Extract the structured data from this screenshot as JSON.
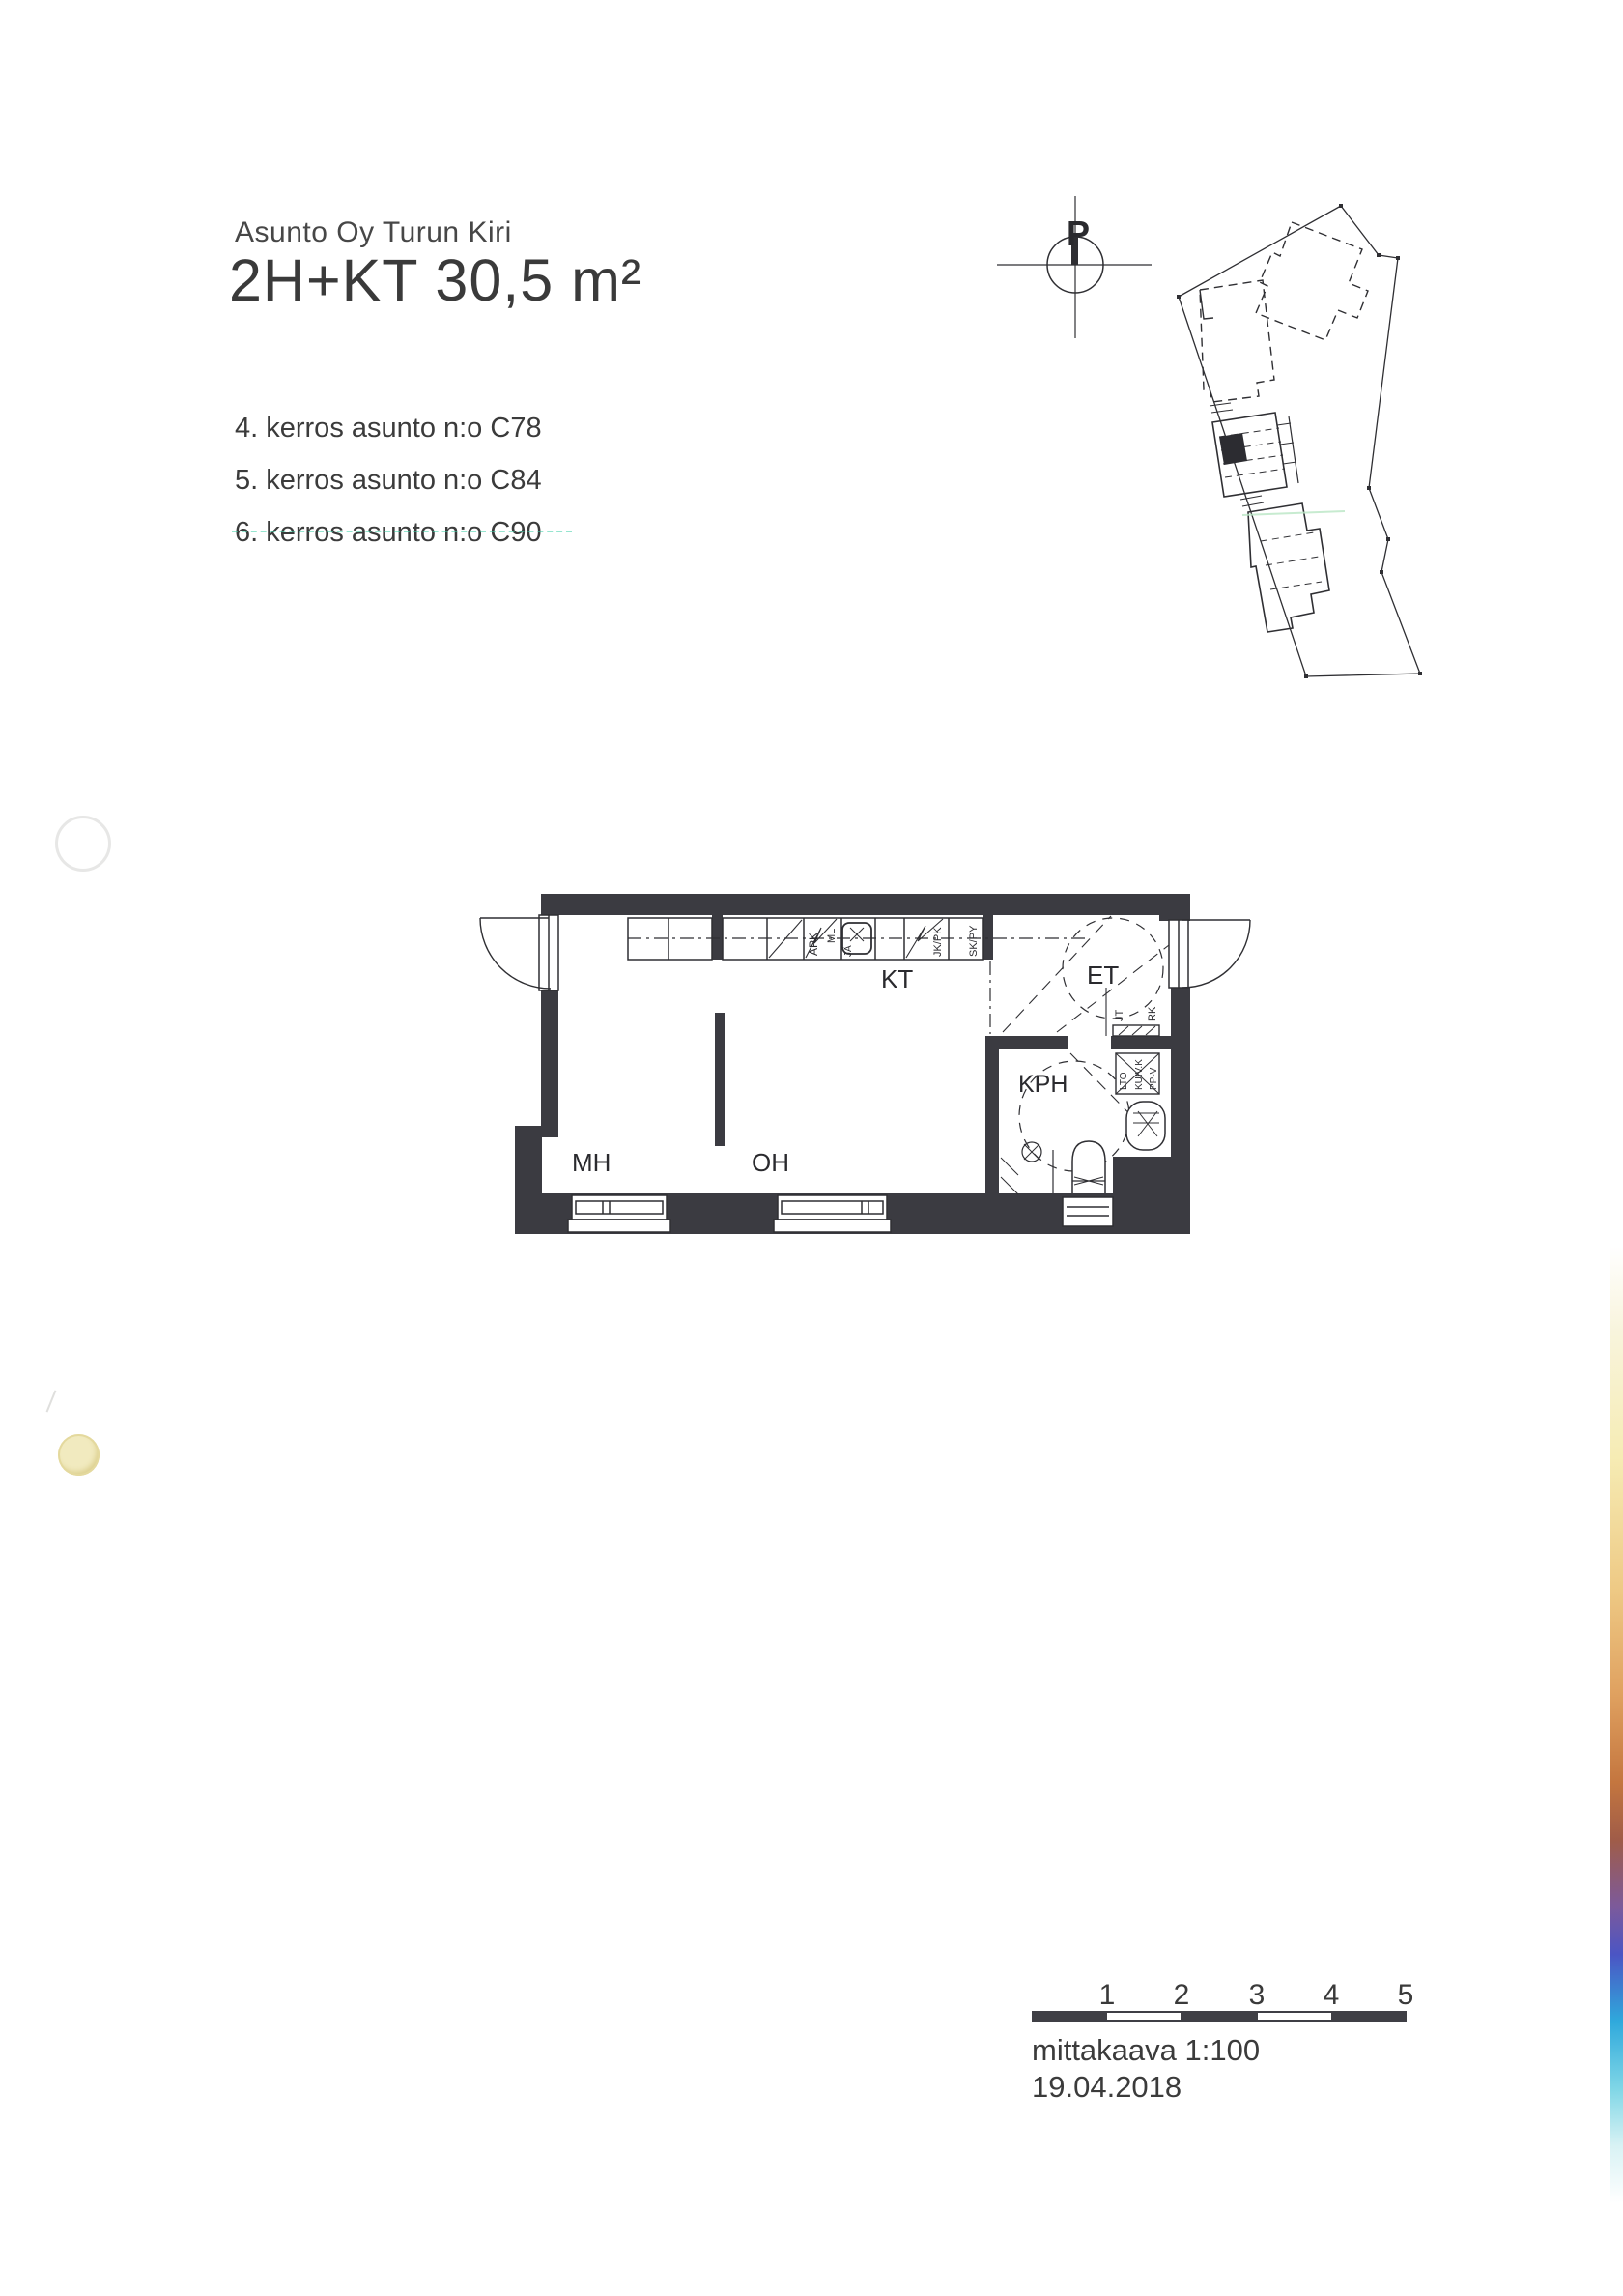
{
  "document": {
    "project": "Asunto Oy Turun Kiri",
    "title": "2H+KT 30,5 m²",
    "apartments": [
      "4. kerros asunto n:o C78",
      "5. kerros asunto n:o C84",
      "6. kerros asunto n:o C90"
    ]
  },
  "site_plan": {
    "north_label": "P"
  },
  "floor_plan": {
    "room_labels": {
      "kt": "KT",
      "et": "ET",
      "kph": "KPH",
      "mh": "MH",
      "oh": "OH"
    },
    "fixture_labels": {
      "apk": "APK",
      "ml": "ML",
      "ja": "JÄ",
      "jk_pk": "JK/PK",
      "sk_py": "SK/PY",
      "jt": "JT",
      "rk": "RK",
      "lto": "LTO",
      "kuiv_k": "KUIV.K",
      "pp_v": "PP-V"
    }
  },
  "scale_bar": {
    "ticks": [
      "1",
      "2",
      "3",
      "4",
      "5"
    ],
    "scale_label": "mittakaava 1:100",
    "date": "19.04.2018"
  },
  "colors": {
    "ink": "#3c3c3c",
    "wall": "#3b3b41",
    "underline_artifact": "#3fd0a8",
    "punch_hole_fill": "#f1eabf",
    "edge_gradient": [
      "#f8f4dc",
      "#f6ecb4",
      "#eec984",
      "#dfa05f",
      "#c4763f",
      "#a05c48",
      "#7c5a9b",
      "#4b55c4",
      "#2fa9dc",
      "#7fd6e6",
      "#d8f2f4"
    ]
  }
}
